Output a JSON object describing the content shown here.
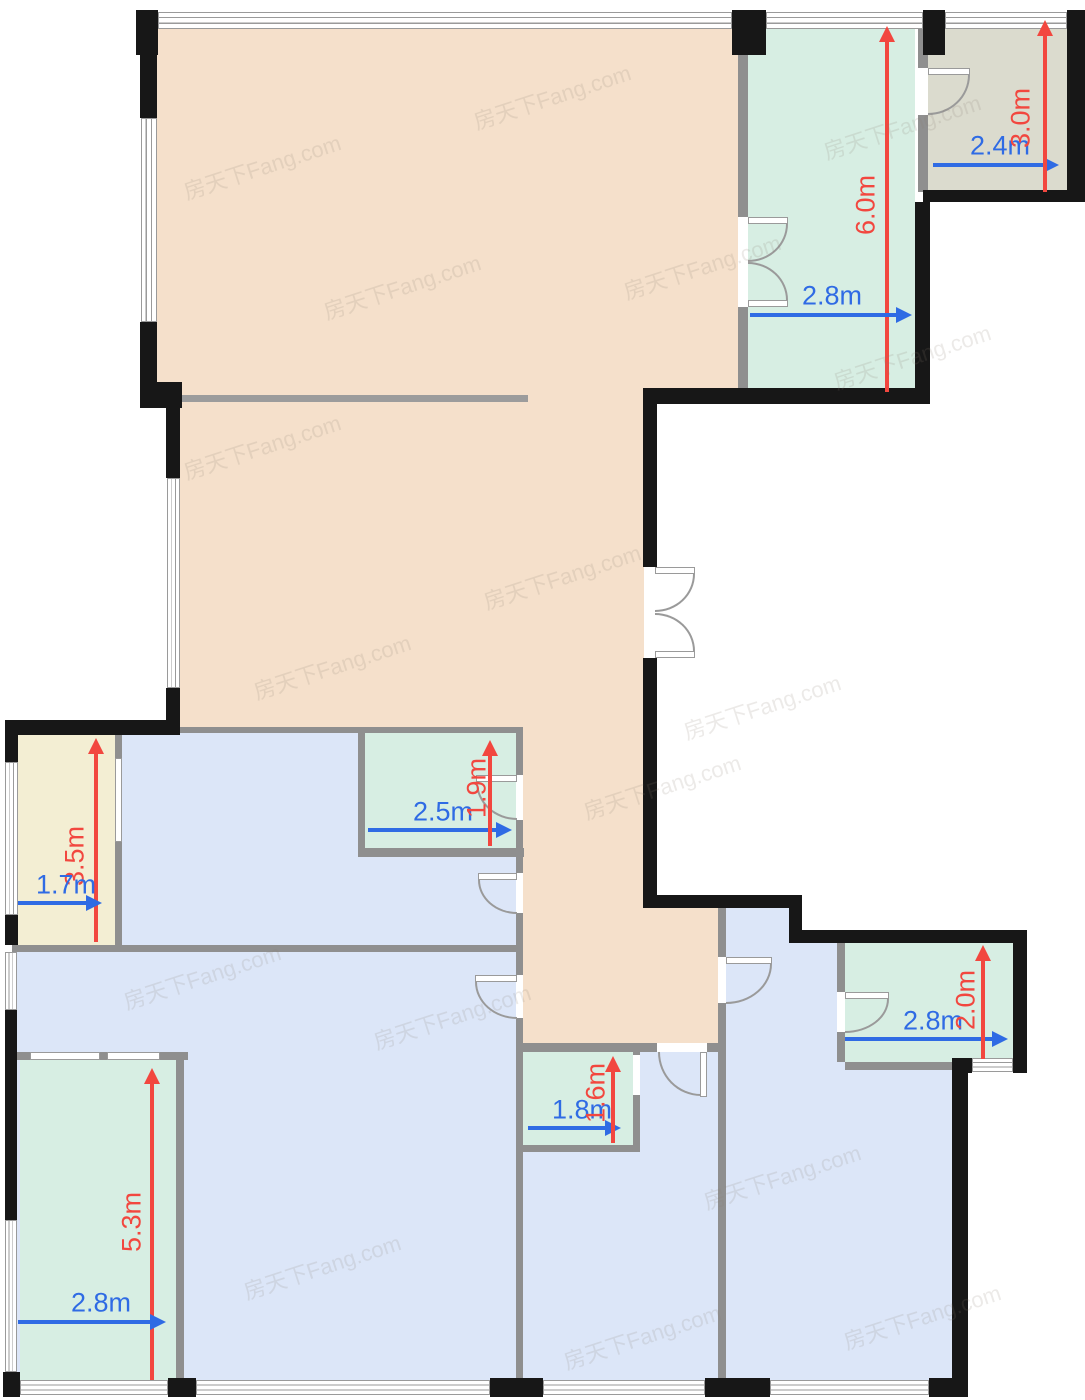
{
  "title": "apartment-floor-plan",
  "watermark": {
    "text": "房天下Fang.com"
  },
  "palette": {
    "living_area": "#f5e0cb",
    "balcony_teal": "#d7eee3",
    "bedroom_blue": "#dce6f8",
    "balcony_yellow": "#f3eed3",
    "utility_gray": "#dbdbce",
    "wall_black": "#171717",
    "wall_gray": "#8f8f8f",
    "dim_red": "#f2473f",
    "dim_blue": "#2f6be4"
  },
  "dimensions": [
    {
      "label": "6.0m",
      "axis": "vertical",
      "room": "balcony-top"
    },
    {
      "label": "2.8m",
      "axis": "horizontal",
      "room": "balcony-top"
    },
    {
      "label": "2.4m",
      "axis": "horizontal",
      "room": "utility-room"
    },
    {
      "label": "3.0m",
      "axis": "vertical",
      "room": "utility-room"
    },
    {
      "label": "3.5m",
      "axis": "vertical",
      "room": "balcony-left"
    },
    {
      "label": "1.7m",
      "axis": "horizontal",
      "room": "balcony-left"
    },
    {
      "label": "2.5m",
      "axis": "horizontal",
      "room": "bathroom-1"
    },
    {
      "label": "1.9m",
      "axis": "vertical",
      "room": "bathroom-1"
    },
    {
      "label": "1.8m",
      "axis": "horizontal",
      "room": "bathroom-2"
    },
    {
      "label": "1.6m",
      "axis": "vertical",
      "room": "bathroom-2"
    },
    {
      "label": "2.8m",
      "axis": "horizontal",
      "room": "bathroom-3"
    },
    {
      "label": "2.0m",
      "axis": "vertical",
      "room": "bathroom-3"
    },
    {
      "label": "5.3m",
      "axis": "vertical",
      "room": "balcony-bottom"
    },
    {
      "label": "2.8m",
      "axis": "horizontal",
      "room": "balcony-bottom"
    }
  ]
}
